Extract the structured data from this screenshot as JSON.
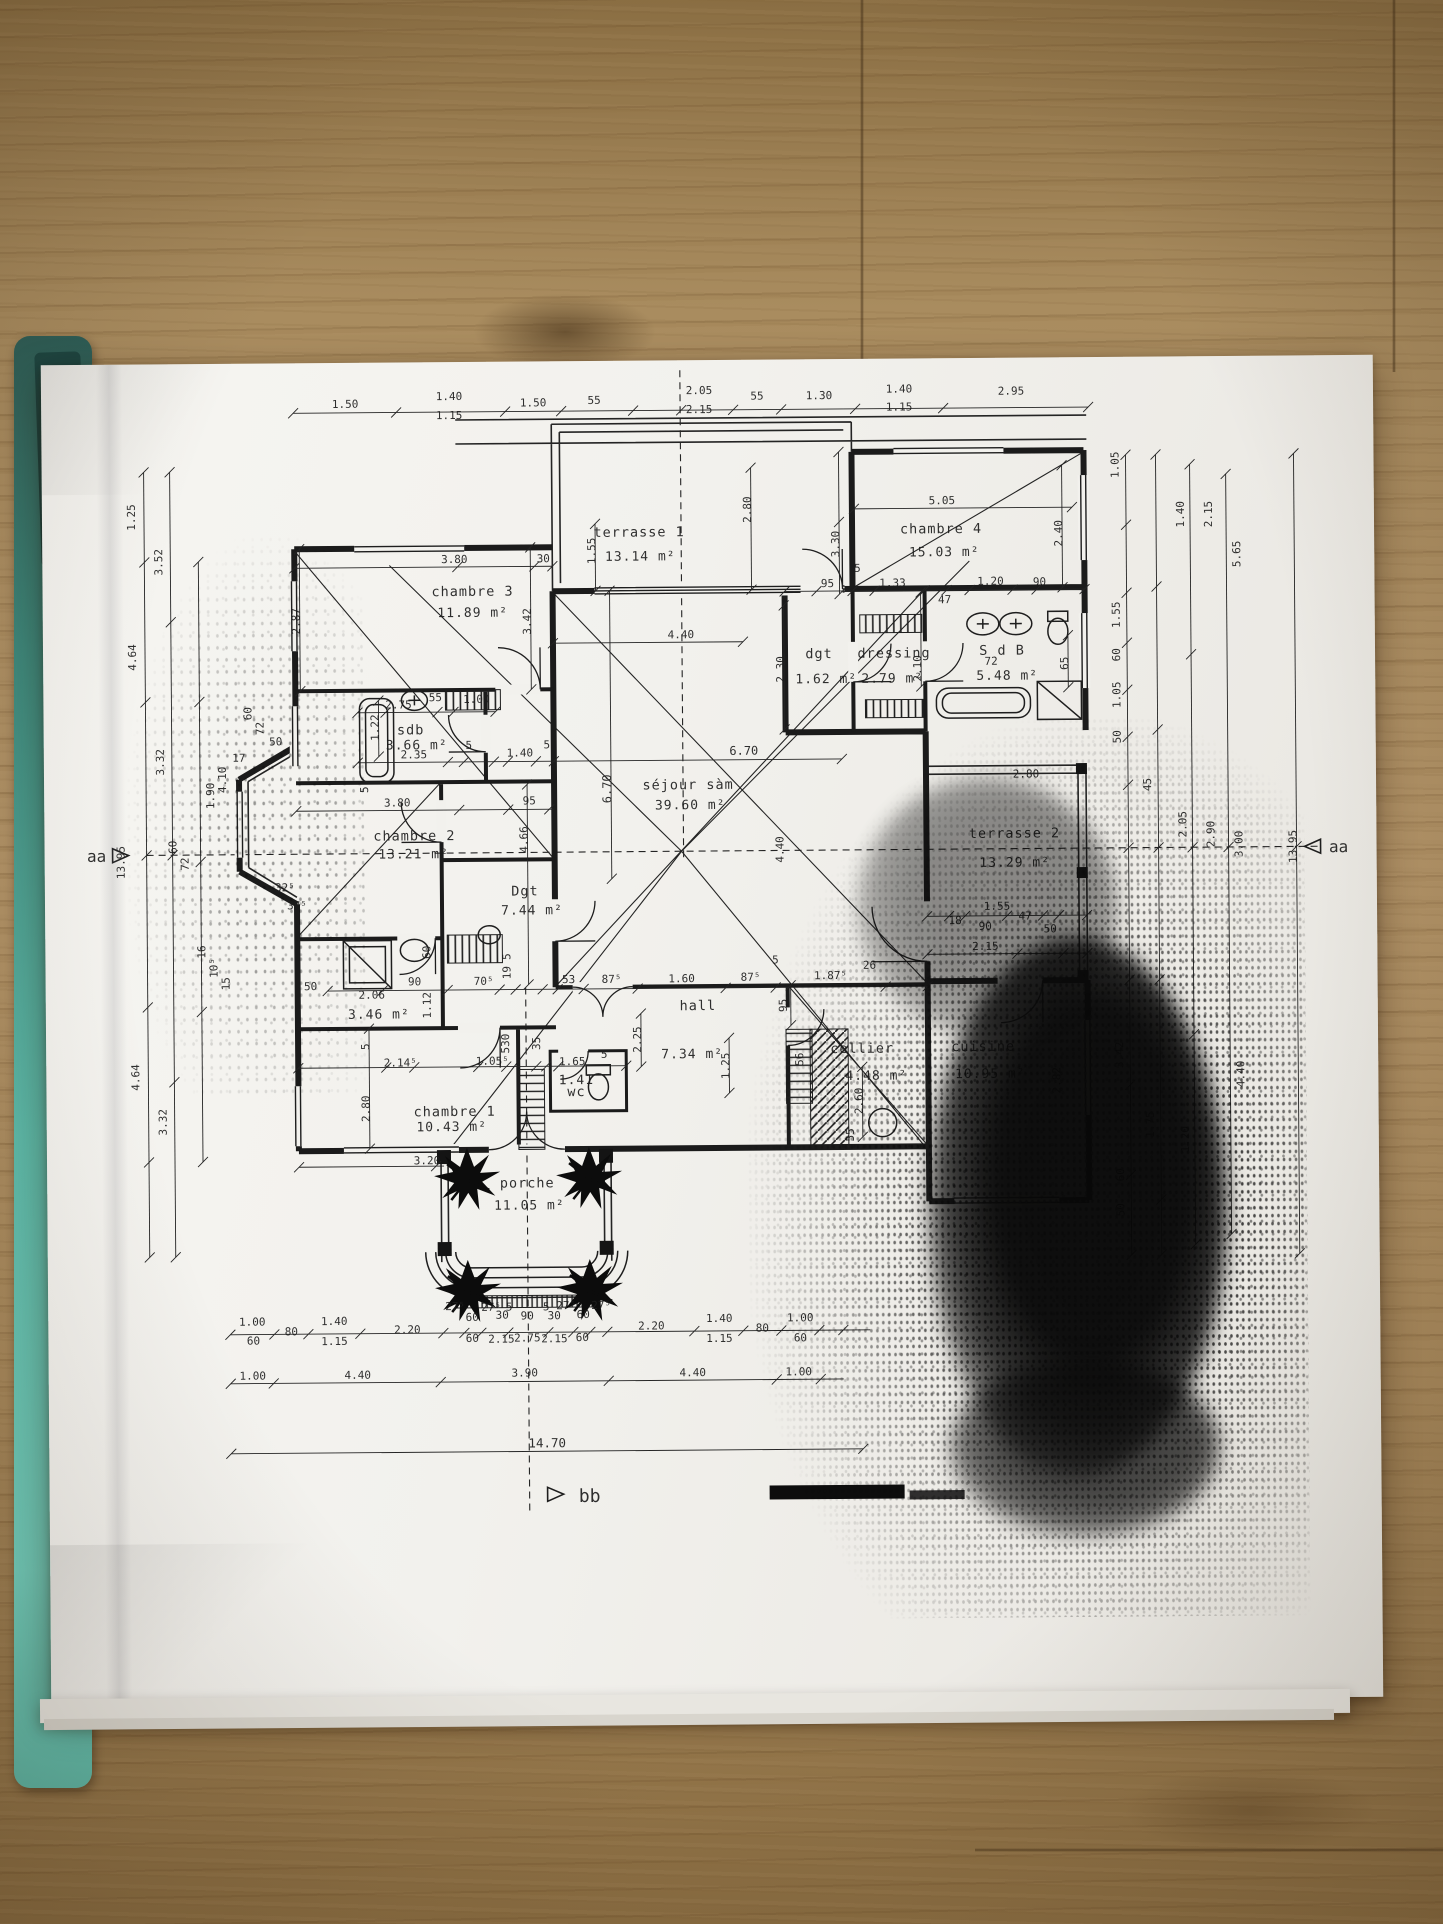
{
  "photo": {
    "surface": "wood-table",
    "wood_color": "#a98c5f",
    "paper_color": "#f2f1ed",
    "folder_color": "#5fbfae",
    "ink_color": "#1e1e1e"
  },
  "plan": {
    "section_labels": {
      "left": "aa",
      "right": "aa",
      "bottom": "bb"
    },
    "rooms": [
      {
        "name": "terrasse 1",
        "area": "13.14 m²",
        "nx": 645,
        "ny": 538,
        "ax": 646,
        "ay": 562
      },
      {
        "name": "chambre 4",
        "area": "15.03 m²",
        "nx": 947,
        "ny": 537,
        "ax": 950,
        "ay": 560
      },
      {
        "name": "chambre 3",
        "area": "11.89 m²",
        "nx": 478,
        "ny": 596,
        "ax": 478,
        "ay": 617
      },
      {
        "name": "sdb",
        "area": "3.66 m²",
        "nx": 415,
        "ny": 734,
        "ax": 421,
        "ay": 749
      },
      {
        "name": "chambre 2",
        "area": "13.21 m²",
        "nx": 418,
        "ny": 840,
        "ax": 417,
        "ay": 858
      },
      {
        "name": "dgt",
        "area": "1.62 m²",
        "nx": 824,
        "ny": 661,
        "ax": 831,
        "ay": 686
      },
      {
        "name": "dressing",
        "area": "2.79 m²",
        "nx": 899,
        "ny": 661,
        "ax": 897,
        "ay": 686
      },
      {
        "name": "S d B",
        "area": "5.48 m²",
        "nx": 1007,
        "ny": 659,
        "ax": 1012,
        "ay": 684
      },
      {
        "name": "séjour sàm",
        "area": "39.60 m²",
        "nx": 692,
        "ny": 791,
        "ax": 694,
        "ay": 811
      },
      {
        "name": "terrasse 2",
        "area": "13.29 m²",
        "nx": 1018,
        "ny": 842,
        "ax": 1018,
        "ay": 871
      },
      {
        "name": "Dgt",
        "area": "7.44 m²",
        "nx": 528,
        "ny": 896,
        "ax": 535,
        "ay": 915
      },
      {
        "name": "hall",
        "area": "7.34 m²",
        "nx": 700,
        "ny": 1012,
        "ax": 694,
        "ay": 1060
      },
      {
        "name": "chambre 1",
        "area": "10.43 m²",
        "nx": 456,
        "ny": 1116,
        "ax": 453,
        "ay": 1131
      },
      {
        "name": "",
        "area": "3.46 m²",
        "nx": 0,
        "ny": 0,
        "ax": 381,
        "ay": 1018
      },
      {
        "name": "wc",
        "area": "1.41",
        "nx": 578,
        "ny": 1097,
        "ax": 578,
        "ay": 1085
      },
      {
        "name": "cellier",
        "area": "4.48 m²",
        "nx": 864,
        "ny": 1056,
        "ax": 878,
        "ay": 1083
      },
      {
        "name": "cuisine",
        "area": "10.95 m²",
        "nx": 985,
        "ny": 1055,
        "ax": 992,
        "ay": 1082
      },
      {
        "name": "porche",
        "area": "11.05 m²",
        "nx": 528,
        "ny": 1188,
        "ax": 530,
        "ay": 1210
      }
    ],
    "dim_labels": [
      [
        "1.50",
        352,
        407
      ],
      [
        "1.40",
        456,
        400
      ],
      [
        "1.15",
        456,
        419
      ],
      [
        "1.50",
        540,
        407
      ],
      [
        "55",
        601,
        405
      ],
      [
        "2.05",
        706,
        396
      ],
      [
        "2.15",
        706,
        415
      ],
      [
        "55",
        764,
        402
      ],
      [
        "1.30",
        826,
        402
      ],
      [
        "1.40",
        906,
        396
      ],
      [
        "1.15",
        906,
        414
      ],
      [
        "2.95",
        1018,
        399
      ],
      [
        "3.80",
        460,
        563
      ],
      [
        "30",
        549,
        563
      ],
      [
        "1.55",
        601,
        552,
        1
      ],
      [
        "2.80",
        757,
        512,
        1
      ],
      [
        "5.05",
        948,
        508
      ],
      [
        "3.30",
        845,
        547,
        1
      ],
      [
        "2.40",
        1068,
        538,
        1
      ],
      [
        "3.42",
        536,
        622,
        1
      ],
      [
        "2.87",
        305,
        620,
        1
      ],
      [
        "95",
        833,
        590
      ],
      [
        "1.33",
        898,
        590
      ],
      [
        "47",
        950,
        607
      ],
      [
        "1.20",
        996,
        589
      ],
      [
        "90",
        1045,
        590
      ],
      [
        "5",
        863,
        575
      ],
      [
        "2.30",
        789,
        672,
        1
      ],
      [
        "2.10",
        926,
        672,
        1
      ],
      [
        "65",
        1073,
        668,
        1
      ],
      [
        "72",
        996,
        669
      ],
      [
        "4.40",
        686,
        640
      ],
      [
        "6.70",
        748,
        757,
        0,
        12
      ],
      [
        "6.70",
        615,
        790,
        1,
        12
      ],
      [
        "2.75",
        403,
        708
      ],
      [
        "55",
        440,
        701
      ],
      [
        "1.00",
        481,
        703
      ],
      [
        "2.35",
        418,
        758
      ],
      [
        "1.22",
        383,
        727,
        1
      ],
      [
        "5",
        473,
        749
      ],
      [
        "1.40",
        524,
        757
      ],
      [
        "5",
        551,
        749
      ],
      [
        "95",
        533,
        805
      ],
      [
        "5",
        372,
        789,
        1
      ],
      [
        "3.80",
        401,
        806
      ],
      [
        "4.66",
        531,
        840,
        1
      ],
      [
        "60",
        256,
        712,
        1
      ],
      [
        "72",
        268,
        727,
        1
      ],
      [
        "50",
        280,
        744
      ],
      [
        "17",
        243,
        760
      ],
      [
        "4.10",
        230,
        778,
        1
      ],
      [
        "1.90",
        218,
        794,
        1
      ],
      [
        "32⁵",
        288,
        890
      ],
      [
        "37⁵",
        300,
        908
      ],
      [
        "16",
        208,
        950,
        1
      ],
      [
        "10⁵",
        220,
        966,
        1
      ],
      [
        "15",
        232,
        982,
        1
      ],
      [
        "60",
        180,
        845,
        1
      ],
      [
        "72",
        192,
        862,
        1
      ],
      [
        "1.25",
        141,
        515,
        1
      ],
      [
        "4.64",
        141,
        655,
        1
      ],
      [
        "4.64",
        141,
        1075,
        1
      ],
      [
        "3.52",
        168,
        560,
        1
      ],
      [
        "3.32",
        168,
        760,
        1
      ],
      [
        "3.32",
        168,
        1120,
        1
      ],
      [
        "13.95",
        128,
        860,
        1
      ],
      [
        "90",
        417,
        985
      ],
      [
        "70⁵",
        486,
        985
      ],
      [
        "19",
        513,
        973,
        1
      ],
      [
        "5",
        513,
        957,
        1
      ],
      [
        "53",
        571,
        984
      ],
      [
        "87⁵",
        614,
        984
      ],
      [
        "1.60",
        684,
        984
      ],
      [
        "87⁵",
        753,
        983
      ],
      [
        "1.87⁵",
        833,
        982
      ],
      [
        "5",
        778,
        966
      ],
      [
        "95",
        789,
        1008,
        1
      ],
      [
        "2.25",
        643,
        1041,
        1
      ],
      [
        "1.25",
        731,
        1068,
        1
      ],
      [
        "56",
        805,
        1062,
        1
      ],
      [
        "26",
        872,
        972
      ],
      [
        "2.80",
        1030,
        782
      ],
      [
        "1.55",
        1000,
        914
      ],
      [
        "18",
        958,
        928
      ],
      [
        "90",
        988,
        934
      ],
      [
        "47",
        1028,
        924
      ],
      [
        "50",
        1053,
        937
      ],
      [
        "2.15",
        988,
        954
      ],
      [
        "4.40",
        787,
        852,
        1
      ],
      [
        "50",
        313,
        989
      ],
      [
        "60",
        433,
        952,
        1
      ],
      [
        "1.12",
        433,
        1005,
        1
      ],
      [
        "2.06",
        374,
        998
      ],
      [
        "5",
        371,
        1046,
        1
      ],
      [
        "2.14⁵",
        402,
        1066
      ],
      [
        "1.05⁵",
        494,
        1065
      ],
      [
        "530",
        511,
        1044,
        1
      ],
      [
        "35",
        542,
        1044,
        1
      ],
      [
        "1.65",
        574,
        1066
      ],
      [
        "5",
        606,
        1059
      ],
      [
        "2.80",
        371,
        1108,
        1
      ],
      [
        "3.20",
        428,
        1164
      ],
      [
        "2.60",
        864,
        1104,
        1
      ],
      [
        "55",
        855,
        1138,
        1
      ],
      [
        "2.82",
        1062,
        1085,
        1
      ],
      [
        "1.00",
        252,
        1324
      ],
      [
        "60",
        253,
        1343
      ],
      [
        "80",
        291,
        1334
      ],
      [
        "1.40",
        334,
        1324
      ],
      [
        "1.15",
        334,
        1344
      ],
      [
        "2.20",
        407,
        1333
      ],
      [
        "27⁵",
        455,
        1310
      ],
      [
        "60",
        472,
        1321
      ],
      [
        "60",
        472,
        1342
      ],
      [
        "27⁵",
        491,
        1311
      ],
      [
        "30",
        502,
        1319
      ],
      [
        "2.15",
        501,
        1343
      ],
      [
        "5",
        509,
        1311
      ],
      [
        "90",
        527,
        1320
      ],
      [
        "2.75",
        527,
        1342
      ],
      [
        "5",
        546,
        1311
      ],
      [
        "30",
        554,
        1320
      ],
      [
        "2.15",
        554,
        1343
      ],
      [
        "27⁵",
        566,
        1310
      ],
      [
        "60",
        583,
        1319
      ],
      [
        "60",
        582,
        1342
      ],
      [
        "27⁵",
        601,
        1310
      ],
      [
        "2.20",
        651,
        1331
      ],
      [
        "1.40",
        719,
        1324
      ],
      [
        "1.15",
        719,
        1344
      ],
      [
        "80",
        762,
        1334
      ],
      [
        "1.00",
        800,
        1324
      ],
      [
        "60",
        800,
        1344
      ],
      [
        "1.00",
        252,
        1378
      ],
      [
        "4.40",
        357,
        1378
      ],
      [
        "3.90",
        524,
        1377
      ],
      [
        "4.40",
        692,
        1378
      ],
      [
        "1.00",
        798,
        1378
      ],
      [
        "14.70",
        546,
        1448,
        0,
        12.5
      ],
      [
        "1.05",
        1125,
        470,
        1
      ],
      [
        "1.40",
        1190,
        520,
        1
      ],
      [
        "2.15",
        1218,
        520,
        1
      ],
      [
        "5.65",
        1246,
        560,
        1
      ],
      [
        "1.55",
        1125,
        620,
        1
      ],
      [
        "60",
        1125,
        660,
        1
      ],
      [
        "1.05",
        1125,
        700,
        1
      ],
      [
        "50",
        1125,
        742,
        1
      ],
      [
        "45",
        1155,
        790,
        1
      ],
      [
        "13.95",
        1300,
        853,
        1
      ],
      [
        "2.05",
        1190,
        830,
        1
      ],
      [
        "2.90",
        1218,
        840,
        1
      ],
      [
        "3.00",
        1246,
        850,
        1
      ],
      [
        "3.42",
        1125,
        1060,
        1
      ],
      [
        "4.40",
        1246,
        1080,
        1
      ],
      [
        "1.75",
        1155,
        1130,
        1
      ],
      [
        "1.20",
        1190,
        1145,
        1
      ],
      [
        "60",
        1125,
        1180,
        1
      ],
      [
        "50",
        1125,
        1215,
        1
      ]
    ]
  }
}
